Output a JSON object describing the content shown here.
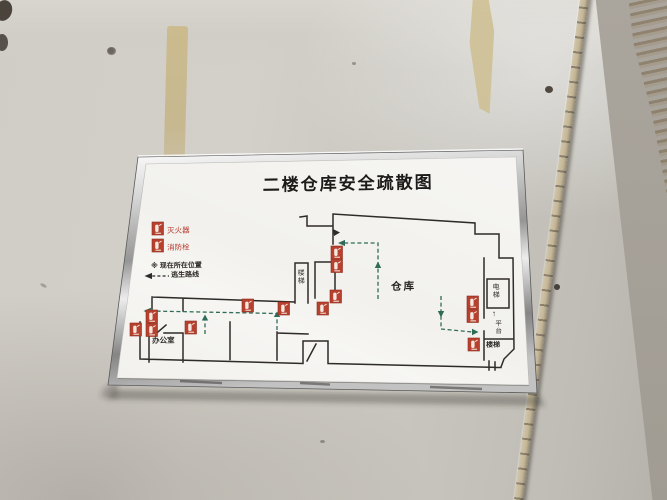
{
  "colors": {
    "wall_gray": "#cbc7c0",
    "board_white": "#f1f0ec",
    "frame_silver": "#c9c9c9",
    "marker_red": "#b8402e",
    "legend_text_red": "#b8372a",
    "route_green": "#2f6b57",
    "plan_line": "#2e2b28",
    "tape_tan": "#c9ba8e"
  },
  "sign": {
    "title": "二楼仓库安全疏散图",
    "legend": {
      "extinguisher_label": "灭火器",
      "hydrant_label": "消防栓",
      "location_line": "※ 现在所在位置",
      "route_label": "逃生路线"
    },
    "rooms": {
      "warehouse": {
        "label": "仓库"
      },
      "office": {
        "label": "办公室"
      },
      "stairs_mid": {
        "label": "楼梯"
      },
      "elevator": {
        "label": "电梯"
      },
      "platform": {
        "label": "平台",
        "arrow": "↑"
      },
      "stairs_right": {
        "label": "楼梯"
      }
    },
    "markers": [
      {
        "type": "fire-equipment",
        "x": 331,
        "y": 246,
        "double": true
      },
      {
        "type": "fire-equipment",
        "x": 330,
        "y": 290,
        "double": false
      },
      {
        "type": "fire-equipment",
        "x": 317,
        "y": 302,
        "double": false
      },
      {
        "type": "fire-equipment",
        "x": 278,
        "y": 302,
        "double": false
      },
      {
        "type": "fire-equipment",
        "x": 242,
        "y": 299,
        "double": false
      },
      {
        "type": "fire-equipment",
        "x": 146,
        "y": 310,
        "double": true
      },
      {
        "type": "fire-equipment",
        "x": 130,
        "y": 323,
        "double": false
      },
      {
        "type": "fire-equipment",
        "x": 185,
        "y": 321,
        "double": false
      },
      {
        "type": "fire-equipment",
        "x": 467,
        "y": 296,
        "double": true
      },
      {
        "type": "fire-equipment",
        "x": 468,
        "y": 338,
        "double": false
      }
    ]
  }
}
